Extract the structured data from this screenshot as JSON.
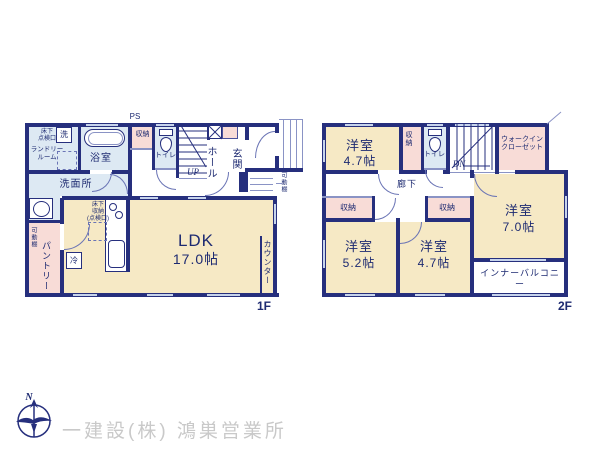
{
  "colors": {
    "wall": "#262f7d",
    "room_cream": "#f6e9c5",
    "room_blue": "#dde9f3",
    "room_pink": "#f8dcd7",
    "window": "#c7d4ec",
    "text_navy": "#1d2a71",
    "company_gray": "#c9c9c9"
  },
  "floor1": {
    "floor_label": "1F",
    "ps": "PS",
    "ldk": {
      "name": "LDK",
      "size": "17.0帖"
    },
    "bath": "浴室",
    "washroom": "洗面所",
    "laundry": "ランドリー\nルーム",
    "underfloor_hatch": "床下\n点検口",
    "washer": "洗",
    "storage": "収納",
    "toilet": "トイレ",
    "up": "UP",
    "hall": "ホール",
    "entrance": "玄関",
    "movable_shelf_entrance": "可動棚",
    "underfloor_storage": "床下\n収納\n(点検口)",
    "fridge": "冷",
    "pantry": "パントリー",
    "movable_shelf_pantry": "可動棚",
    "counter": "カウンター"
  },
  "floor2": {
    "floor_label": "2F",
    "room_a": {
      "name": "洋室",
      "size": "4.7帖"
    },
    "room_b": {
      "name": "洋室",
      "size": "5.2帖"
    },
    "room_c": {
      "name": "洋室",
      "size": "4.7帖"
    },
    "room_d": {
      "name": "洋室",
      "size": "7.0帖"
    },
    "wic": "ウォークイン\nクローゼット",
    "storage_vertical": "収納",
    "toilet": "トイレ",
    "dn": "DN",
    "corridor": "廊下",
    "storage_left": "収納",
    "storage_mid": "収納",
    "inner_balcony": "インナーバルコニー"
  },
  "footer": {
    "compass_n": "N",
    "company": "一建設(株) 鴻巣営業所"
  }
}
